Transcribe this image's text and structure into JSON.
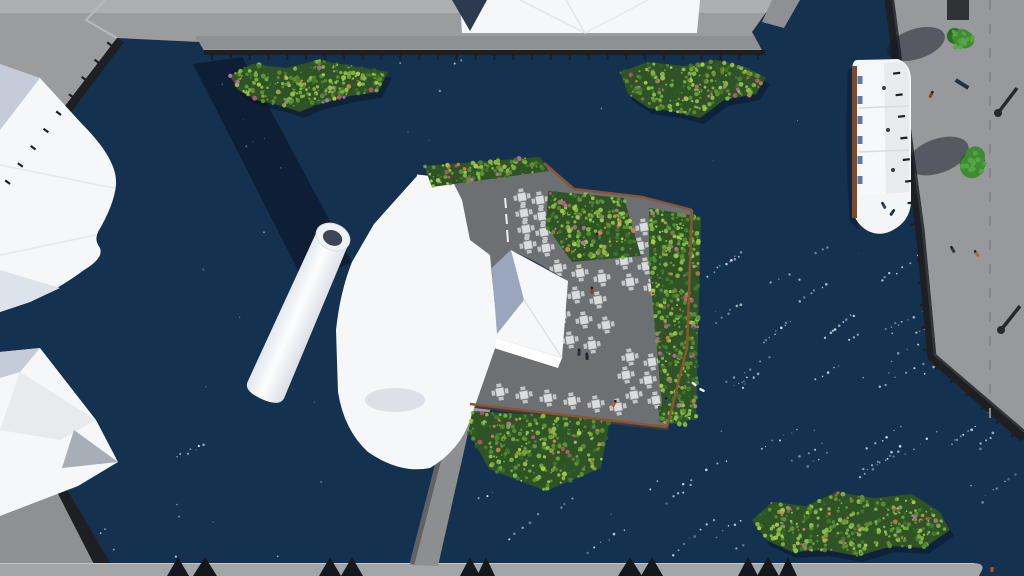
{
  "scene": {
    "description": "aerial-3d-render-harbor-with-floating-terrace-power-plant-and-quays",
    "sparkles": {
      "seed": 7,
      "streaks": 46,
      "singles": 90
    }
  },
  "colors": {
    "water": "#143150",
    "sparkle": "#e8f4fc",
    "shadow": "rgba(8,14,26,0.5)",
    "treeShadow": "rgba(22,26,36,0.5)",
    "quay": "#9b9c9e",
    "quayLight": "#aeafb1",
    "quayWalk": "#8f9093",
    "quayRight": "#98999c",
    "quayBottom": "#a4a5a7",
    "quayBL": "#8e9092",
    "wallDark": "#1d1f22",
    "wallMid": "#34373a",
    "white": "#f5f7f9",
    "whiteShade": "#e7ebee",
    "facetBlue": "#c3ccd8",
    "facetNavy": "#2c3a50",
    "facetLight": "#dde3ea",
    "bluishPale": "#9aa6bd",
    "deck": "#6d7073",
    "planter": "#8a5532",
    "trimDark": "#3b3d40",
    "ramp": "#9b9da0",
    "pier": "#8c8e90",
    "pierEdge": "#606264",
    "vegBase": "#2f5226",
    "treeGreen": "#3f8c36",
    "treeLight": "#57a744",
    "treeDark": "#2d6a29",
    "tableTop": "#dadcde",
    "tableEdge": "#a9abad",
    "chair": "#c3c5c7",
    "boatWhite": "#f3f5f7",
    "boatPanel": "#e8ebee",
    "boatBrown": "#7b4a28",
    "boatSeat": "#4a6b9d",
    "boatDot": "#3a3c3e",
    "triangle": "#14171c",
    "kiosk": "#303234",
    "lamp": "#26282a",
    "bird": "#f2f6f8"
  },
  "vegPalette": [
    "#a6cc4f",
    "#7fb23f",
    "#5d9434",
    "#417a2c",
    "#2e5e26",
    "#8fc14d",
    "#6b8f3a",
    "#c05a74",
    "#b86fa4",
    "#d08a4a"
  ],
  "islands": [
    {
      "pts": [
        [
          230,
          76
        ],
        [
          252,
          64
        ],
        [
          286,
          68
        ],
        [
          318,
          60
        ],
        [
          352,
          66
        ],
        [
          388,
          72
        ],
        [
          378,
          92
        ],
        [
          350,
          96
        ],
        [
          318,
          104
        ],
        [
          300,
          112
        ],
        [
          282,
          106
        ],
        [
          256,
          100
        ],
        [
          238,
          90
        ]
      ],
      "dots": 430
    },
    {
      "pts": [
        [
          620,
          72
        ],
        [
          648,
          62
        ],
        [
          684,
          66
        ],
        [
          716,
          60
        ],
        [
          748,
          68
        ],
        [
          766,
          78
        ],
        [
          756,
          94
        ],
        [
          724,
          100
        ],
        [
          700,
          118
        ],
        [
          676,
          112
        ],
        [
          648,
          108
        ],
        [
          628,
          94
        ]
      ],
      "dots": 390
    },
    {
      "pts": [
        [
          752,
          520
        ],
        [
          772,
          502
        ],
        [
          806,
          506
        ],
        [
          836,
          492
        ],
        [
          874,
          498
        ],
        [
          912,
          494
        ],
        [
          940,
          512
        ],
        [
          950,
          530
        ],
        [
          924,
          548
        ],
        [
          892,
          546
        ],
        [
          858,
          556
        ],
        [
          826,
          550
        ],
        [
          792,
          552
        ],
        [
          766,
          540
        ]
      ],
      "dots": 540
    }
  ],
  "terraceVeg": [
    {
      "pts": [
        [
          424,
          166
        ],
        [
          540,
          157
        ],
        [
          549,
          171
        ],
        [
          432,
          187
        ]
      ],
      "dots": 230
    },
    {
      "pts": [
        [
          548,
          191
        ],
        [
          624,
          198
        ],
        [
          641,
          256
        ],
        [
          572,
          262
        ],
        [
          546,
          226
        ]
      ],
      "dots": 320
    },
    {
      "pts": [
        [
          649,
          208
        ],
        [
          701,
          217
        ],
        [
          696,
          420
        ],
        [
          663,
          419
        ],
        [
          656,
          338
        ],
        [
          649,
          264
        ]
      ],
      "dots": 540
    },
    {
      "pts": [
        [
          472,
          411
        ],
        [
          610,
          419
        ],
        [
          601,
          468
        ],
        [
          546,
          491
        ],
        [
          489,
          469
        ],
        [
          469,
          433
        ]
      ],
      "dots": 440
    },
    {
      "pts": [
        [
          658,
          406
        ],
        [
          688,
          410
        ],
        [
          686,
          425
        ],
        [
          660,
          422
        ]
      ],
      "dots": 60
    }
  ],
  "tables": [
    [
      522,
      197
    ],
    [
      540,
      200
    ],
    [
      524,
      213
    ],
    [
      542,
      216
    ],
    [
      526,
      229
    ],
    [
      544,
      232
    ],
    [
      528,
      245
    ],
    [
      546,
      248
    ],
    [
      558,
      268
    ],
    [
      580,
      273
    ],
    [
      602,
      278
    ],
    [
      554,
      290
    ],
    [
      576,
      295
    ],
    [
      598,
      300
    ],
    [
      562,
      315
    ],
    [
      584,
      320
    ],
    [
      606,
      325
    ],
    [
      570,
      340
    ],
    [
      592,
      345
    ],
    [
      622,
      222
    ],
    [
      644,
      227
    ],
    [
      618,
      241
    ],
    [
      640,
      246
    ],
    [
      624,
      261
    ],
    [
      646,
      266
    ],
    [
      630,
      282
    ],
    [
      652,
      287
    ],
    [
      630,
      357
    ],
    [
      652,
      362
    ],
    [
      626,
      375
    ],
    [
      648,
      380
    ],
    [
      634,
      395
    ],
    [
      656,
      400
    ],
    [
      500,
      392
    ],
    [
      524,
      395
    ],
    [
      548,
      398
    ],
    [
      572,
      401
    ],
    [
      596,
      404
    ],
    [
      618,
      407
    ]
  ],
  "people": [
    {
      "x": 592,
      "y": 291,
      "c": "#7a4a28"
    },
    {
      "x": 597,
      "y": 237,
      "c": "#3a3f46"
    },
    {
      "x": 579,
      "y": 353,
      "c": "#2a3140"
    },
    {
      "x": 587,
      "y": 357,
      "c": "#1f2630"
    },
    {
      "x": 614,
      "y": 404,
      "c": "#c05a2a"
    },
    {
      "x": 668,
      "y": 401,
      "c": "#3a4a6a"
    },
    {
      "x": 931,
      "y": 95,
      "c": "#8a3a2a"
    },
    {
      "x": 953,
      "y": 250,
      "c": "#2e3440"
    },
    {
      "x": 977,
      "y": 254,
      "c": "#c06030"
    },
    {
      "x": 992,
      "y": 569,
      "c": "#b05a30"
    },
    {
      "x": 884,
      "y": 206,
      "c": "#32405e"
    },
    {
      "x": 892,
      "y": 213,
      "c": "#26334e"
    }
  ],
  "birds": [
    [
      694,
      384
    ],
    [
      702,
      390
    ]
  ],
  "mooredBows": [
    [
      178,
      22
    ],
    [
      205,
      24
    ],
    [
      330,
      22
    ],
    [
      352,
      22
    ],
    [
      470,
      20
    ],
    [
      486,
      18
    ],
    [
      630,
      24
    ],
    [
      652,
      22
    ],
    [
      748,
      20
    ],
    [
      768,
      22
    ],
    [
      788,
      18
    ]
  ],
  "trees": [
    {
      "x": 962,
      "y": 38,
      "r": 14,
      "sx": 916,
      "sy": 44,
      "srx": 30,
      "sry": 15,
      "rot": -18
    },
    {
      "x": 973,
      "y": 163,
      "r": 15,
      "sx": 938,
      "sy": 156,
      "srx": 32,
      "sry": 17,
      "rot": -20
    }
  ],
  "lamps": [
    {
      "bx": 1017,
      "by": 88,
      "hx": 998,
      "hy": 113
    },
    {
      "bx": 1020,
      "by": 306,
      "hx": 1001,
      "hy": 330
    }
  ],
  "bench": {
    "x": 962,
    "y": 84,
    "rot": 32,
    "w": 15,
    "h": 4
  },
  "boat": {
    "dots": [
      [
        884,
        88
      ],
      [
        888,
        130
      ],
      [
        893,
        170
      ]
    ],
    "seatYs": [
      76,
      96,
      116,
      136,
      156,
      176
    ],
    "panelYs": [
      108,
      152
    ]
  },
  "bollardEdges": [
    {
      "a": [
        212,
        55
      ],
      "b": [
        758,
        55
      ],
      "n": 29,
      "len": 5,
      "dir": [
        0,
        1
      ]
    },
    {
      "a": [
        10,
        184
      ],
      "b": [
        112,
        46
      ],
      "n": 8,
      "len": 6,
      "dir": [
        -0.8,
        -0.6
      ]
    },
    {
      "a": [
        893,
        8
      ],
      "b": [
        917,
        224
      ],
      "n": 10,
      "len": 7,
      "dir": [
        -1,
        0.12
      ]
    },
    {
      "a": [
        922,
        238
      ],
      "b": [
        930,
        350
      ],
      "n": 5,
      "len": 7,
      "dir": [
        -1,
        0
      ]
    },
    {
      "a": [
        940,
        364
      ],
      "b": [
        1016,
        432
      ],
      "n": 5,
      "len": 7,
      "dir": [
        -0.7,
        0.7
      ]
    }
  ]
}
